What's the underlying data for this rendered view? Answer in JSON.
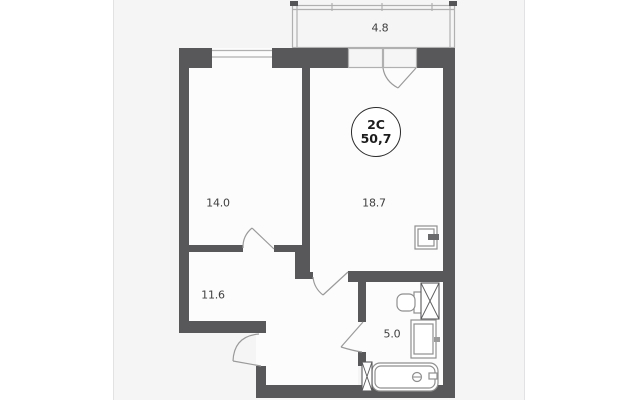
{
  "plan": {
    "badge": {
      "type_label": "2C",
      "total_area": "50,7"
    },
    "rooms": [
      {
        "name": "balcony",
        "area": "4.8"
      },
      {
        "name": "room",
        "area": "14.0"
      },
      {
        "name": "kitchen-living-room",
        "area": "18.7"
      },
      {
        "name": "hallway",
        "area": "11.6"
      },
      {
        "name": "bathroom",
        "area": "5.0"
      }
    ],
    "colors": {
      "wall": "#58585a",
      "floor": "#fcfcfc",
      "balcony_floor": "#fafafa",
      "panel_background": "#f5f5f6",
      "line": "#b0b0b0",
      "text": "#3f3f3f"
    }
  }
}
